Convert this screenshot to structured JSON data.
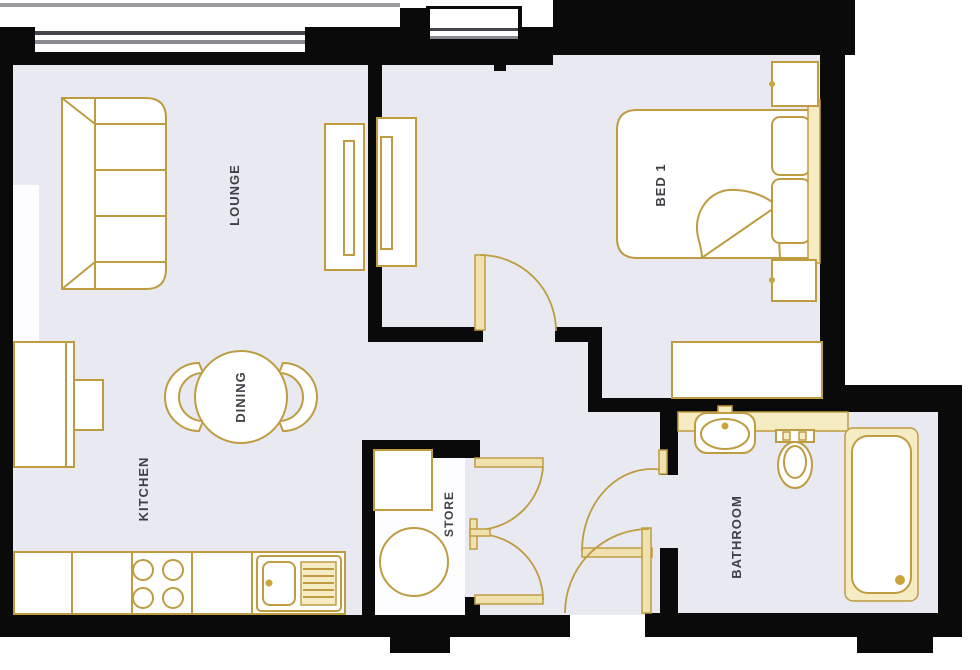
{
  "title": "Apartment floor plan",
  "rooms": {
    "lounge": {
      "label": "LOUNGE"
    },
    "bed1": {
      "label": "BED 1"
    },
    "dining": {
      "label": "DINING"
    },
    "kitchen": {
      "label": "KITCHEN"
    },
    "store": {
      "label": "STORE"
    },
    "bathroom": {
      "label": "BATHROOM"
    }
  },
  "colors": {
    "wall": "#0a0a0a",
    "floor": "#e9e9f1",
    "store_floor": "#fdfdff",
    "furniture_outline": "#bf9c42",
    "furniture_fill": "#ffffff",
    "door_leaf_fill": "#efe2ae",
    "fixture_cream": "#f6ecc4",
    "label_text": "#3f3f46",
    "glazing_dark": "#44444a",
    "glazing_gray": "#8a8a92",
    "sill_gray": "#9a9aa0"
  }
}
